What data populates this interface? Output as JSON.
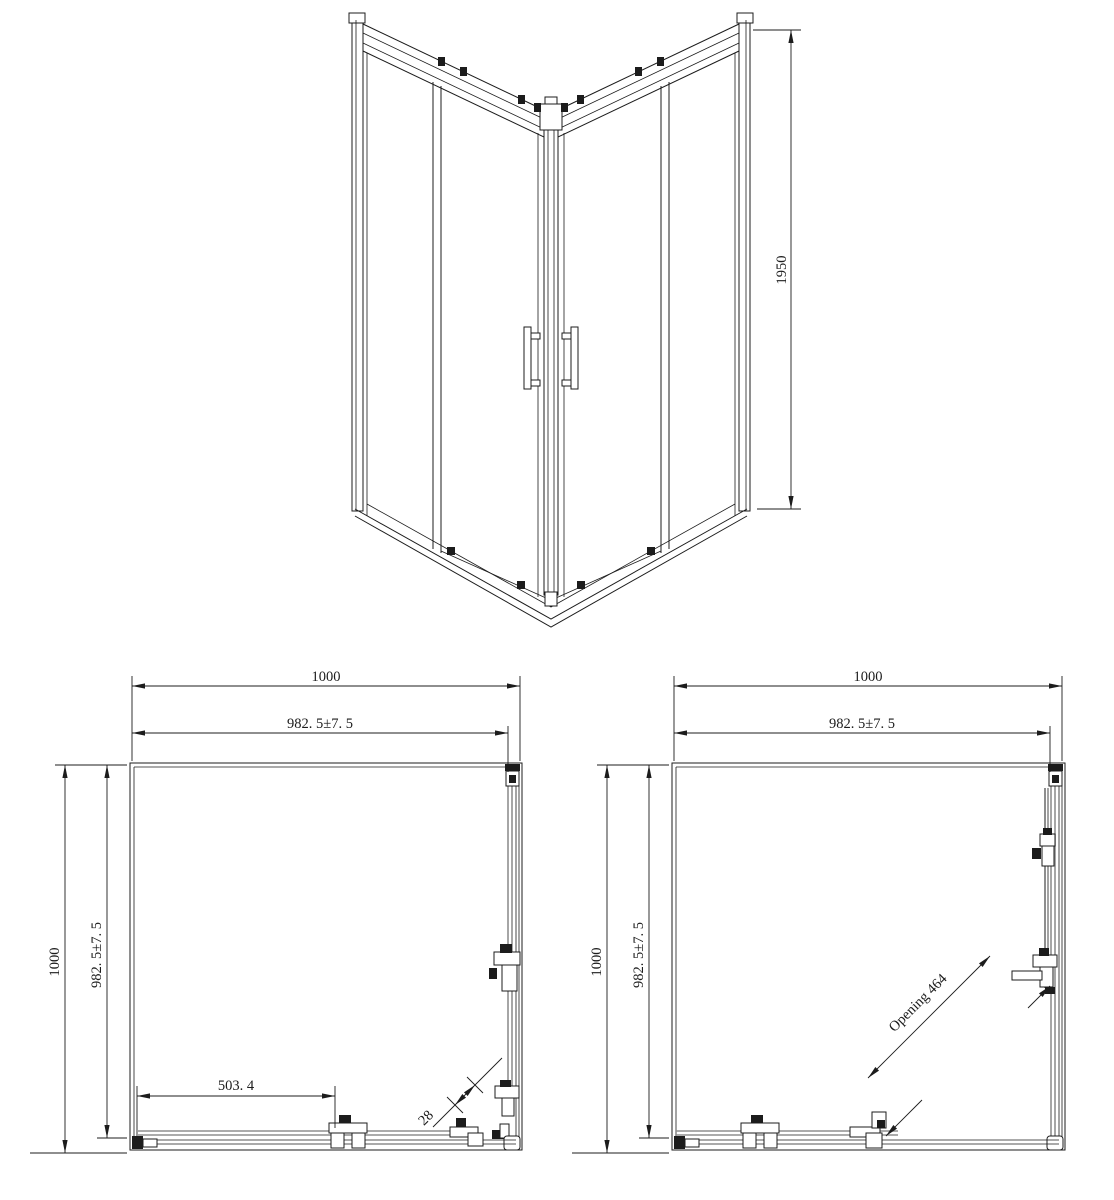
{
  "views": {
    "front": {
      "height_dim": "1950"
    },
    "plan_closed": {
      "outer_width_dim": "1000",
      "glass_width_dim": "982. 5±7. 5",
      "outer_depth_dim": "1000",
      "glass_depth_dim": "982. 5±7. 5",
      "door_width_dim": "503. 4",
      "overlap_dim": "28"
    },
    "plan_open": {
      "outer_width_dim": "1000",
      "glass_width_dim": "982. 5±7. 5",
      "outer_depth_dim": "1000",
      "glass_depth_dim": "982. 5±7. 5",
      "opening_dim": "Opening 464"
    }
  },
  "colors": {
    "line": "#1c1c1c",
    "track": "#8f8f8f",
    "background": "#ffffff"
  }
}
